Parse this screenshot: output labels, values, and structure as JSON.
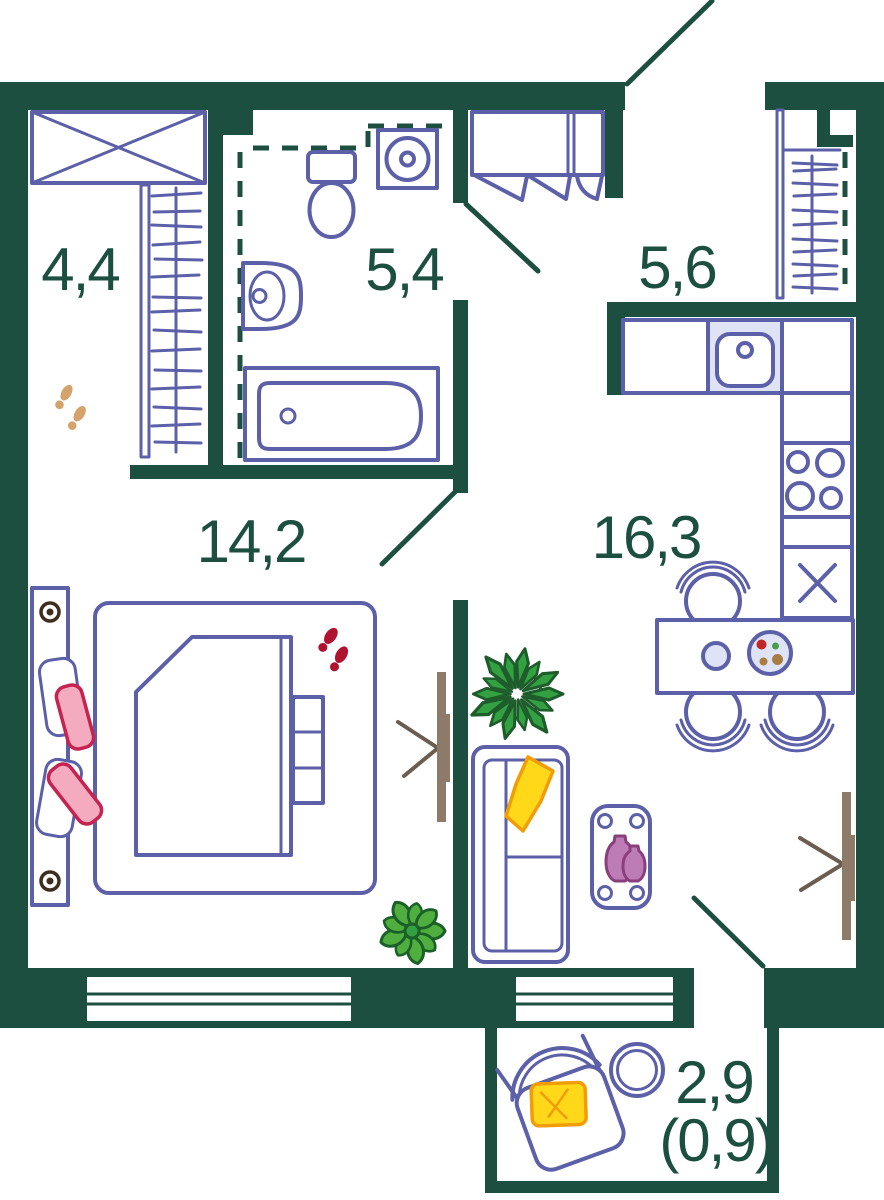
{
  "rooms": [
    {
      "id": "wardrobe",
      "area": "4,4"
    },
    {
      "id": "bathroom",
      "area": "5,4"
    },
    {
      "id": "hallway",
      "area": "5,6"
    },
    {
      "id": "bedroom",
      "area": "14,2"
    },
    {
      "id": "kitchen-living-room",
      "area": "16,3"
    },
    {
      "id": "balcony",
      "area": "2,9",
      "area_secondary": "(0,9)"
    }
  ],
  "colors": {
    "wall": "#1d4f41",
    "furniture": "#5c60a8",
    "furniture-light": "#dfe3f6",
    "pink": "#f4aabf",
    "pink-stroke": "#c52350",
    "red": "#b01330",
    "yellow": "#ffd81a",
    "yellow-stroke": "#f29d05",
    "plant": "#33a042",
    "plant-dark": "#1e5c2c",
    "plant2": "#4fae3d",
    "plant2-dark": "#1b6029",
    "purple": "#bd7cb5",
    "purple-stroke": "#8a3f7d",
    "tan": "#8d7a69",
    "tan-dark": "#6b5d4f",
    "footprint": "#d3a36b",
    "knob": "#3f2d1e",
    "food-red": "#c22626",
    "food-green": "#43a047",
    "food-brown": "#a97c44"
  },
  "legend": {
    "symbols": [
      "wardrobe-cabinet",
      "clothes-rail",
      "washing-machine",
      "toilet",
      "washbasin",
      "bathtub",
      "entry-closet",
      "coat-niche",
      "kitchen-counter",
      "kitchen-sink",
      "stove",
      "refrigerator",
      "dining-table",
      "dining-chair",
      "plate",
      "bed",
      "pillow",
      "slippers",
      "footprints",
      "tv",
      "sofa",
      "throw-blanket",
      "coffee-table",
      "vase",
      "plant",
      "lounge-chair",
      "balcony-table",
      "window",
      "entry-door",
      "interior-door",
      "balcony-door"
    ]
  }
}
